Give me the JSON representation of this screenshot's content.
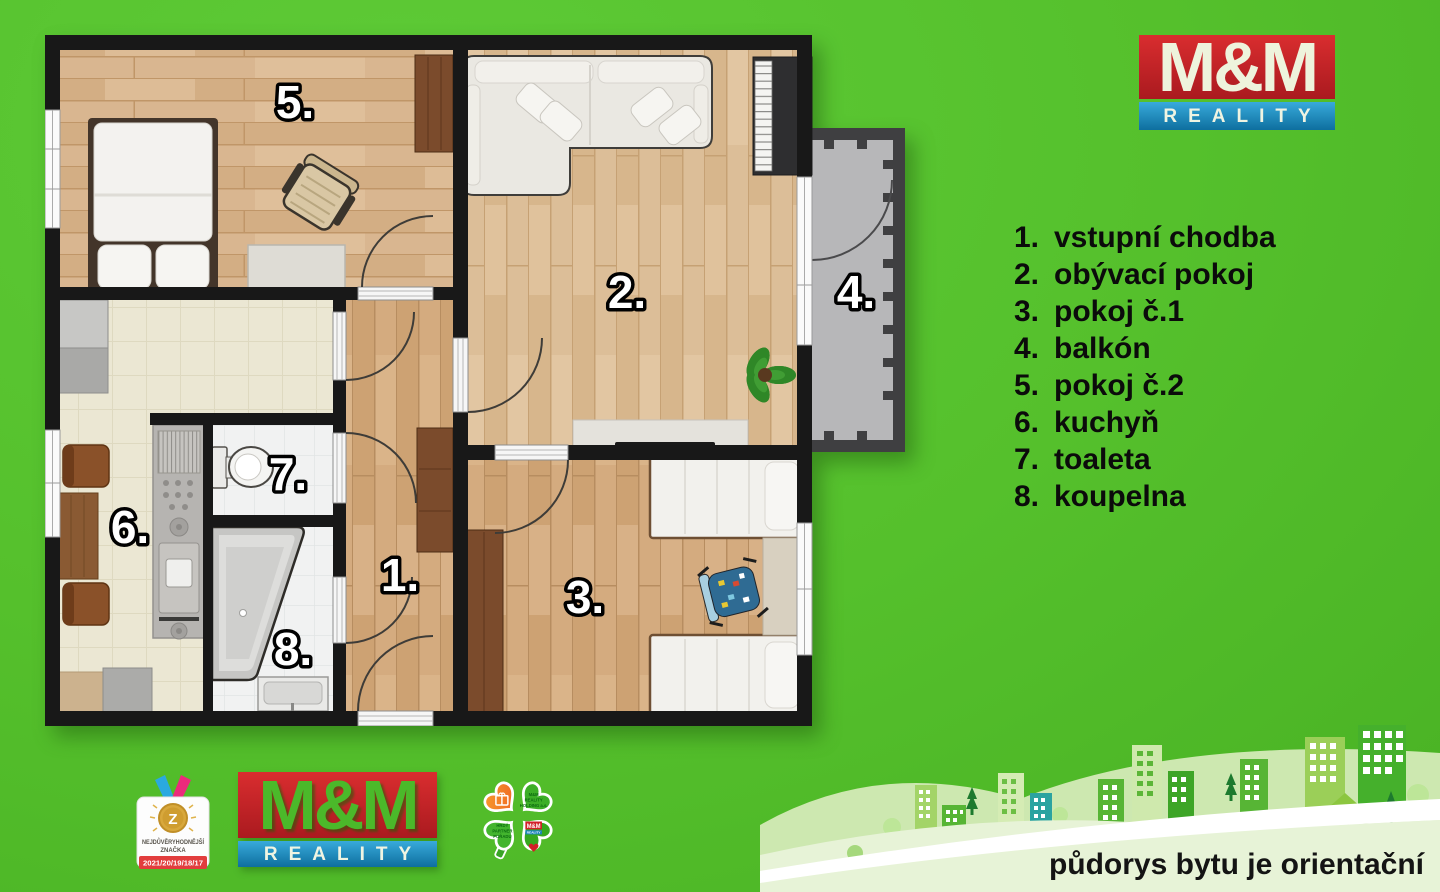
{
  "brand": {
    "mm": "M&M",
    "reality": "REALITY",
    "red": "#c6201f",
    "blue": "#1b84bc",
    "background_green": "#55c02c"
  },
  "legend": {
    "items": [
      {
        "num": "1.",
        "label": "vstupní chodba"
      },
      {
        "num": "2.",
        "label": "obývací pokoj"
      },
      {
        "num": "3.",
        "label": "pokoj č.1"
      },
      {
        "num": "4.",
        "label": "balkón"
      },
      {
        "num": "5.",
        "label": "pokoj č.2"
      },
      {
        "num": "6.",
        "label": "kuchyň"
      },
      {
        "num": "7.",
        "label": "toaleta"
      },
      {
        "num": "8.",
        "label": "koupelna"
      }
    ]
  },
  "floor_plan": {
    "room_labels": [
      "1.",
      "2.",
      "3.",
      "4.",
      "5.",
      "6.",
      "7.",
      "8."
    ]
  },
  "badges": {
    "trust": {
      "line1": "NEJDŮVĚRYHODNĚJŠÍ",
      "line2": "ZNAČKA",
      "medal_letter": "Z",
      "years": "2021/20/19/18/17"
    },
    "clover": {
      "holding": [
        "M&M",
        "REALITY",
        "HOLDING a.s."
      ],
      "partner": [
        "HRDÝ",
        "PARTNER",
        "POŘADU"
      ],
      "mini_mm": "M&M",
      "mini_reality": "REALITY"
    }
  },
  "footer": {
    "note": "půdorys bytu je orientační"
  }
}
